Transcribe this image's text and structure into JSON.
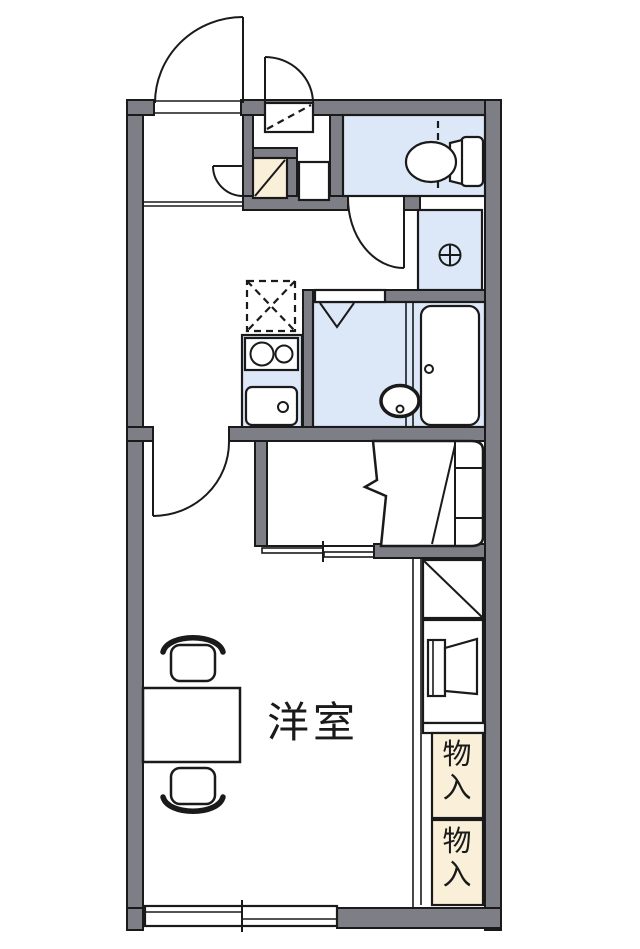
{
  "plan": {
    "type": "apartment-floor-plan",
    "rooms": {
      "main_label": "洋室"
    },
    "storage": {
      "upper_label": "物入",
      "lower_label": "物入"
    },
    "colors": {
      "wall": "#7e7e86",
      "fixture_blue": "#dce8f8",
      "storage_beige": "#faf0da",
      "line": "#1a1a1a",
      "bg": "#ffffff"
    }
  }
}
